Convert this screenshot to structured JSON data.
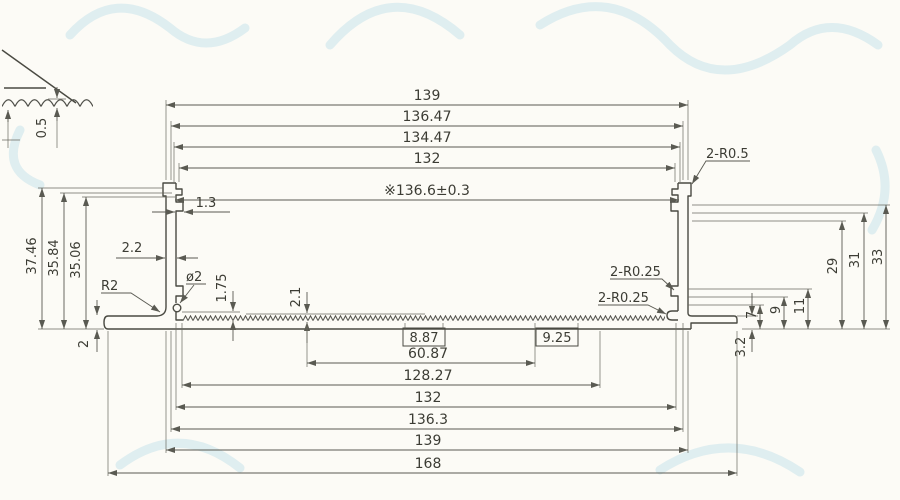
{
  "drawing": {
    "kind": "aluminum-extrusion-cross-section",
    "colors": {
      "line": "#4a4a42",
      "dimension": "#5a5a52",
      "text": "#3c3c34",
      "watermark": "#bcdde8",
      "background": "#fcfbf6"
    },
    "dims": {
      "top": [
        "139",
        "136.47",
        "134.47",
        "132"
      ],
      "inner_width": "※136.6±0.3",
      "top_right_radius": "2-R0.5",
      "left_vertical": [
        "37.46",
        "35.84",
        "35.06"
      ],
      "detail_wave_height": "0.5",
      "wall_notch": "1.3",
      "wall_thickness": "2.2",
      "fillet_radius": "R2",
      "hole_diameter": "ø2",
      "hole_offset": "1.75",
      "serration_height": "2.1",
      "base_thickness": "2",
      "right_radius_upper": "2-R0.25",
      "right_radius_lower": "2-R0.25",
      "right_small": [
        "7",
        "9",
        "11"
      ],
      "right_large": [
        "29",
        "31",
        "33"
      ],
      "foot_height": "3.2",
      "bottom_boxed": [
        "8.87",
        "9.25"
      ],
      "bottom": [
        "60.87",
        "128.27",
        "132",
        "136.3",
        "139",
        "168"
      ]
    }
  }
}
